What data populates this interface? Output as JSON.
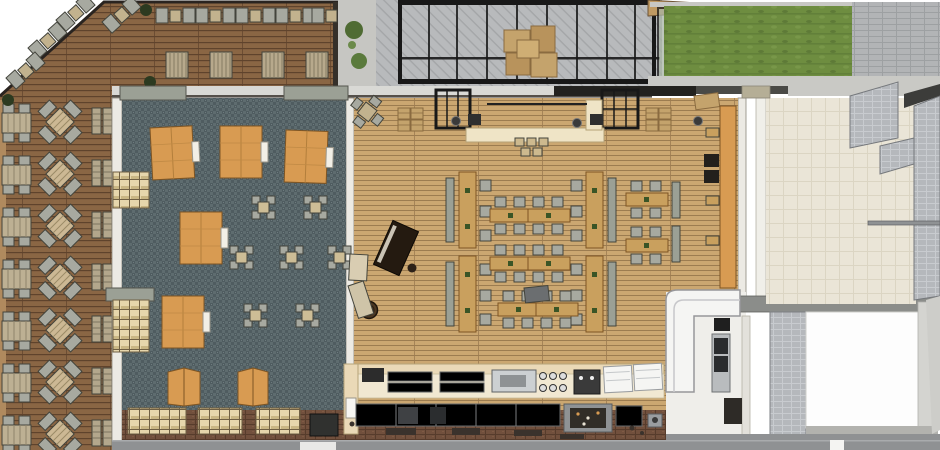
{
  "scene": {
    "title": "Restaurant floor plan - overhead 3D render",
    "description": "Top-down rendered plan of a cafe/restaurant with outdoor decks, glazed courtyard, carpeted lounge room, main dining hall, kitchen line and back-of-house rooms",
    "width": 940,
    "height": 450
  },
  "palette": {
    "deck-wood": "#8a6644",
    "deck-line": "#5f432c",
    "deck-edge": "#b08a5e",
    "hall-wood": "#cba771",
    "hall-line": "#9c7c50",
    "carpet": "#4f5c60",
    "carpet-light": "#5e6c6f",
    "orange": "#d89b52",
    "orange-dark": "#7e5524",
    "table-tan": "#c9a05e",
    "bench-gray": "#9ba095",
    "chair-gray": "#a7a9a0",
    "furn-dark": "#43443c",
    "cream": "#efe4c6",
    "cream-dark": "#b5a277",
    "counter-cream": "#ead9b7",
    "white": "#f5f5f3",
    "white-floor": "#fdfdfd",
    "paving": "#b8babc",
    "paving-line": "#a4a6a8",
    "brick-pave": "#b2b4b6",
    "lawn": "#6e8d40",
    "lawn-dark": "#62803a",
    "brick-floor": "#71503d",
    "brick-line": "#573c2c",
    "tile-beige": "#eae5d7",
    "tile-line": "#dbd5c3",
    "gray-tile": "#b5b8bc",
    "gray-tile-line": "#c8cbcf",
    "wall-light": "#eceae4",
    "wall-gray": "#d9d9d5",
    "wall-dark": "#55504a",
    "wall-band": "#8b8d8a",
    "steel": "#a4a7a9",
    "steel-dark": "#64676a",
    "black": "#181818",
    "plant": "#3a5526",
    "bush": "#2c3a20",
    "shelf-tan": "#e6d6ac",
    "shelf-line": "#6f5f43",
    "cardboard": "#c4a36c",
    "cardboard-dark": "#8a6b40",
    "sidewalk": "#8f9193",
    "piano": "#241a10",
    "barrel": "#4a3723",
    "glass-green": "#a8b4a4"
  },
  "zones": [
    {
      "id": "deck-west",
      "label": "Outdoor terrace deck (west) with 7 rows of four-seat tables and wall benches",
      "floor": "deck-wood"
    },
    {
      "id": "deck-north",
      "label": "Outdoor terrace deck (north) with chair pairs and 4 sun loungers",
      "floor": "deck-wood"
    },
    {
      "id": "planting-strip",
      "label": "Paved strip with shrubs",
      "floor": "paving"
    },
    {
      "id": "courtyard",
      "label": "Glazed steel-frame courtyard with stacked cardboard boxes",
      "floor": "paving"
    },
    {
      "id": "lawn",
      "label": "Lawn strip (north-east)",
      "floor": "lawn"
    },
    {
      "id": "paving-ne",
      "label": "Brick paving (north-east corner)",
      "floor": "brick-pave"
    },
    {
      "id": "lounge-room",
      "label": "Carpeted lounge room with 6 orange platform tables, 7 low stool tables, 2 orange screens and storage cubbies",
      "floor": "carpet"
    },
    {
      "id": "dining-hall",
      "label": "Main dining hall with bench table clusters, service counter, two black pergola frames, upright piano, barrel and wall banquette",
      "floor": "hall-wood"
    },
    {
      "id": "kitchen",
      "label": "Kitchen line with bar counter, equipment and display cases",
      "floor": "brick-floor"
    },
    {
      "id": "back-room",
      "label": "Back-of-house tiled room with gray tile partitions",
      "floor": "tile-beige"
    },
    {
      "id": "service-corner",
      "label": "Service corner with white L-shaped display counter",
      "floor": "white"
    },
    {
      "id": "store-room",
      "label": "Storage room with white floor",
      "floor": "white-floor"
    },
    {
      "id": "sidewalk",
      "label": "Sidewalk edge",
      "floor": "sidewalk"
    }
  ]
}
